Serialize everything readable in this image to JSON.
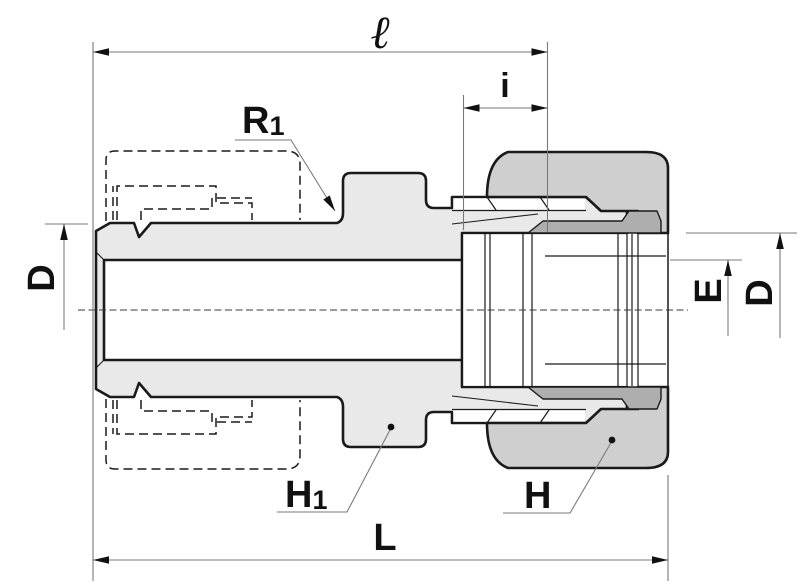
{
  "drawing": {
    "type": "technical-drawing",
    "subject": "tube fitting cross-section with coupling nut",
    "labels": {
      "ell": "ℓ",
      "i": "i",
      "r1_base": "R",
      "r1_sub": "1",
      "d_left": "D",
      "e_right": "E",
      "d_right": "D",
      "h1_base": "H",
      "h1_sub": "1",
      "h": "H",
      "l": "L"
    },
    "colors": {
      "background": "#ffffff",
      "body_fill": "#e9e9e9",
      "nut_fill": "#cfcfcf",
      "cone_shadow_fill": "#aeaeae",
      "outline": "#1a1a1a",
      "dimension_lines": "#7a7a7a",
      "text": "#111111"
    }
  }
}
